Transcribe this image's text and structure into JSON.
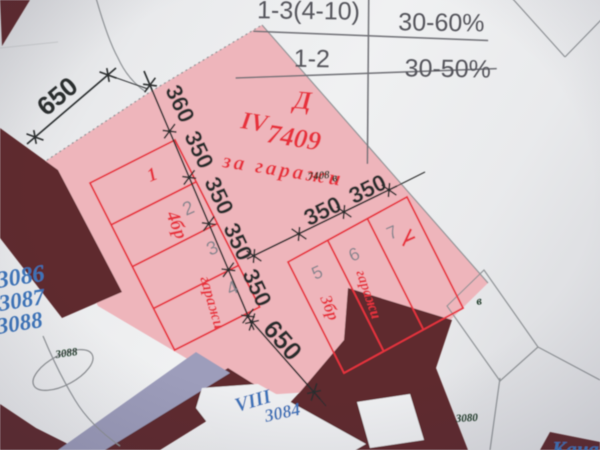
{
  "table": {
    "rows": [
      {
        "range": "1-3(4-10)",
        "percent": "30-60%"
      },
      {
        "range": "1-2",
        "percent": "30-50%"
      }
    ]
  },
  "dimensions": {
    "top_left": "650",
    "chain": [
      "360",
      "350",
      "350",
      "350",
      "350"
    ],
    "branch": [
      "350",
      "350"
    ],
    "bottom": "650"
  },
  "parcel": {
    "block_letter": "Д",
    "roman": "IV",
    "number": "7409",
    "designation": "за гаражи",
    "small_number": "7408"
  },
  "garages_left": {
    "count": "4бр",
    "type": "гаражи",
    "cells": [
      "1",
      "2",
      "3",
      "4"
    ]
  },
  "garages_right": {
    "count": "3бр",
    "type": "гаражи",
    "cells": [
      "5",
      "6",
      "7"
    ]
  },
  "neighbor_parcels": {
    "left": [
      "3086",
      "3087",
      "3088"
    ],
    "bottom_roman": "VIII",
    "bottom_number": "3084",
    "corner_fragment": "Кана",
    "ellipse_number": "3088",
    "right_number": "3080",
    "letter_marks": [
      "в",
      "в"
    ]
  },
  "colors": {
    "pink": "#eeb5bb",
    "red": "#e7333e",
    "maroon": "#5e2b2d",
    "lavender": "#9d9dbb",
    "blue": "#3d74ba",
    "table_ink": "#55555c",
    "dimension_ink": "#2b2d2f"
  }
}
